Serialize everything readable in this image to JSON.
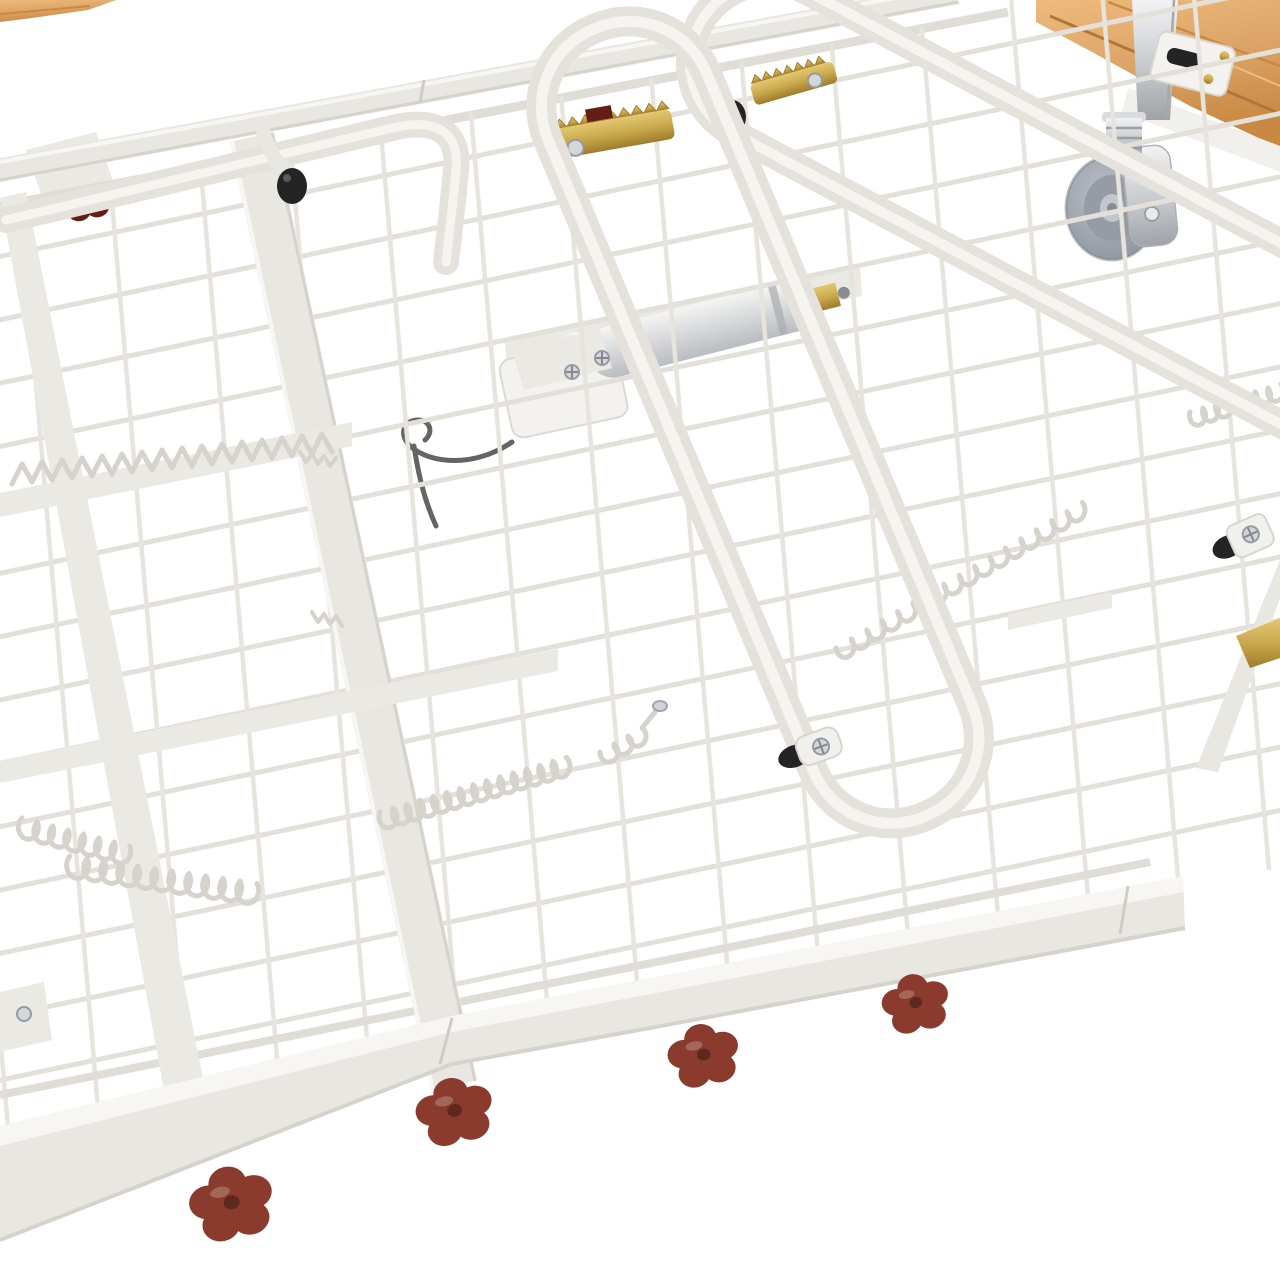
{
  "scene": {
    "description": "Close-up product photo of a white hospital adjustable bed frame deck: powder-coated steel wire mesh sleeping surface seen at a diagonal angle, with a grey swivel caster, silver linear actuator, beech wood slats, brass ratchet brackets, coil retaining springs and dark red flower-shaped knobs under the side rail, on a plain white background",
    "subject": "adjustable-bed-frame-deck"
  },
  "objects": [
    {
      "name": "wire-mesh-deck",
      "label": "white wire mesh bed deck"
    },
    {
      "name": "far-side-rail",
      "label": "far side rail"
    },
    {
      "name": "near-side-rail",
      "label": "near side rail"
    },
    {
      "name": "backrest-tube-frame",
      "label": "rounded tube backrest frame"
    },
    {
      "name": "second-tube-frame",
      "label": "second rounded tube frame"
    },
    {
      "name": "linear-actuator",
      "label": "silver linear actuator with motor"
    },
    {
      "name": "swivel-caster",
      "label": "grey swivel caster wheel"
    },
    {
      "name": "wood-slats",
      "label": "beech wood slats"
    },
    {
      "name": "wood-corner",
      "label": "beech wood corner piece"
    },
    {
      "name": "coil-springs",
      "label": "mesh retaining coil springs"
    },
    {
      "name": "ratchet-brackets",
      "label": "brass ratchet brackets"
    },
    {
      "name": "red-knobs",
      "label": "dark red flower-shaped hand knobs"
    },
    {
      "name": "rubber-stoppers",
      "label": "black rubber stoppers"
    },
    {
      "name": "pivot-bolts",
      "label": "pivot bolts with chrome screws"
    }
  ],
  "palette": {
    "background": "#ffffff",
    "frame": "#e9e7e1",
    "frame_light": "#f7f6f3",
    "frame_mid": "#ebe9e3",
    "frame_shadow": "#d6d3cc",
    "frame_edge": "#cfccc5",
    "mesh_wire": "#e3e0da",
    "mesh_cross": "#e7e4de",
    "border_wire": "#e0ddd7",
    "spring": "#d6d3cc",
    "tube": "#e5e2dc",
    "tube_light": "#f5f4f1",
    "wood_light": "#eebb7d",
    "wood": "#dca567",
    "wood_dark": "#c98943",
    "wood_seam": "#b0763a",
    "chrome_light": "#f2f3f4",
    "chrome": "#c7cacd",
    "chrome_dark": "#9fa3a8",
    "wheel_light": "#b9bec5",
    "wheel_dark": "#8b919b",
    "hub": "#969ca6",
    "silver_light": "#f5f5f4",
    "silver_dark": "#b9bcc0",
    "motor": "#f3f2ef",
    "gold_light": "#e3c870",
    "gold": "#c9a94e",
    "gold_dark": "#a07c2a",
    "rubber": "#242424",
    "knob_red": "#8a3b2d",
    "knob_red_dark": "#631f15",
    "cable": "#646464",
    "white_part": "#f1f0ed"
  }
}
